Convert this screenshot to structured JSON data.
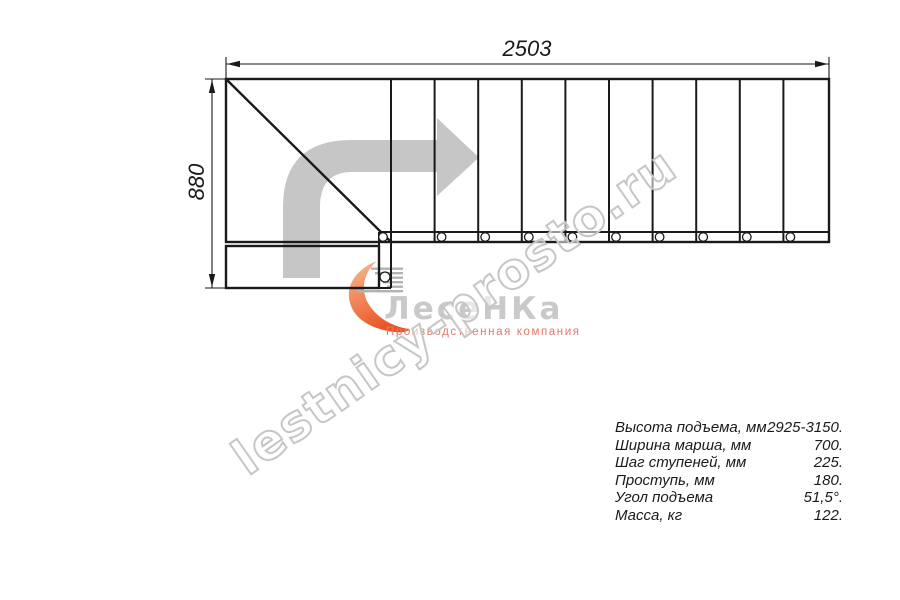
{
  "dimensions": {
    "width_mm": "2503",
    "height_mm": "880"
  },
  "specs": {
    "rows": [
      {
        "label": "Высота подъема, мм",
        "value": "2925-3150."
      },
      {
        "label": "Ширина марша, мм",
        "value": "700."
      },
      {
        "label": "Шаг ступеней, мм",
        "value": "225."
      },
      {
        "label": "Проступь, мм",
        "value": "180."
      },
      {
        "label": "Угол подъема",
        "value": "51,5°."
      },
      {
        "label": "Масса, кг",
        "value": "122."
      }
    ]
  },
  "watermark": {
    "text": "lestnicy-prosto.ru"
  },
  "logo": {
    "name": "ЛесеНКа",
    "subtitle": "Производственная компания"
  },
  "colors": {
    "line_black": "#1a1a1a",
    "direction_arrow_gray": "#c6c6c6",
    "watermark_gray": "#c6c6c6",
    "logo_text_gray": "#c9c9c9",
    "logo_orange_light": "#f8bd92",
    "logo_orange_dark": "#eb5526",
    "logo_subtitle_red": "#e4776b"
  }
}
